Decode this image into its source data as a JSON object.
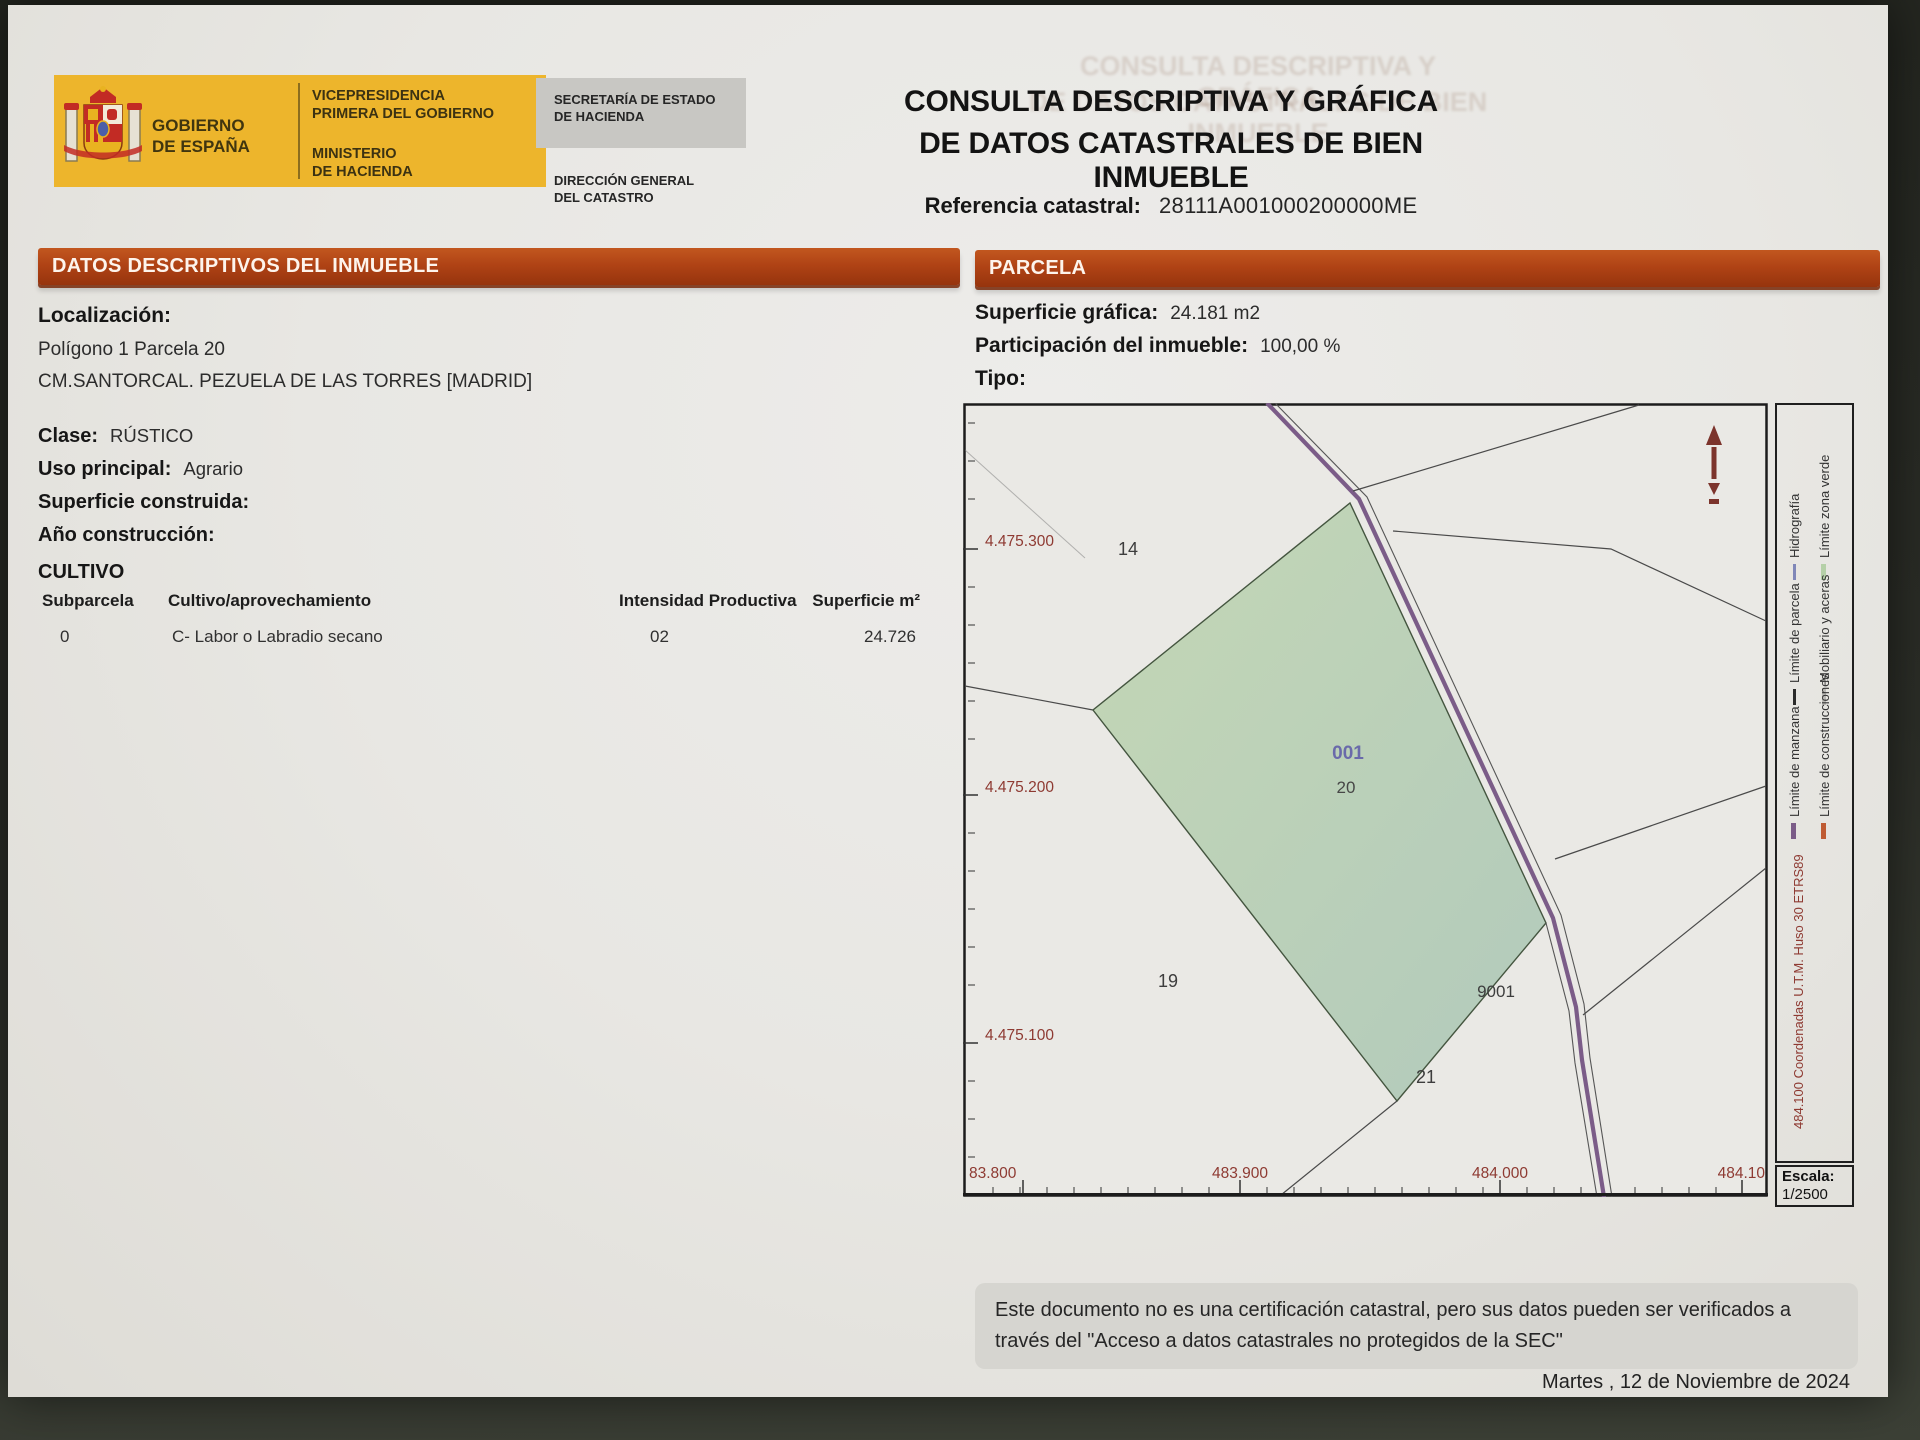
{
  "header": {
    "gobierno": "GOBIERNO\nDE ESPAÑA",
    "vicepresidencia": "VICEPRESIDENCIA\nPRIMERA DEL GOBIERNO",
    "ministerio": "MINISTERIO\nDE HACIENDA",
    "secretaria": "SECRETARÍA DE ESTADO\nDE HACIENDA",
    "direccion": "DIRECCIÓN GENERAL\nDEL CATASTRO",
    "title_line1": "CONSULTA DESCRIPTIVA Y GRÁFICA",
    "title_line2": "DE DATOS CATASTRALES DE BIEN INMUEBLE",
    "referencia_label": "Referencia catastral:",
    "referencia_value": "28111A001000200000ME"
  },
  "datos": {
    "section_title": "DATOS DESCRIPTIVOS DEL INMUEBLE",
    "localizacion_label": "Localización:",
    "localizacion_line1": "Polígono 1 Parcela 20",
    "localizacion_line2": "CM.SANTORCAL. PEZUELA DE LAS TORRES [MADRID]",
    "clase_label": "Clase:",
    "clase_value": "RÚSTICO",
    "uso_label": "Uso principal:",
    "uso_value": "Agrario",
    "superficie_label": "Superficie construida:",
    "anio_label": "Año construcción:",
    "cultivo_title": "CULTIVO",
    "cultivo_table": {
      "headers": [
        "Subparcela",
        "Cultivo/aprovechamiento",
        "Intensidad Productiva",
        "Superficie m²"
      ],
      "rows": [
        [
          "0",
          "C- Labor o Labradio secano",
          "02",
          "24.726"
        ]
      ]
    }
  },
  "parcela": {
    "section_title": "PARCELA",
    "superficie_grafica_label": "Superficie gráfica:",
    "superficie_grafica_value": "24.181 m2",
    "participacion_label": "Participación del inmueble:",
    "participacion_value": "100,00 %",
    "tipo_label": "Tipo:"
  },
  "map": {
    "y_axis_labels": [
      "4.475.300",
      "4.475.200",
      "4.475.100"
    ],
    "x_axis_labels": [
      "83.800",
      "483.900",
      "484.000",
      "484.10"
    ],
    "parcel_14": "14",
    "parcel_19": "19",
    "parcel_20": "20",
    "parcel_21": "21",
    "parcel_9001": "9001",
    "subparcela": "001",
    "escala_label": "Escala:",
    "escala_value": "1/2500",
    "north_arrow_icon": "north-arrow",
    "legend": {
      "hidrografia": "Hidrografía",
      "zona_verde": "Límite zona verde",
      "parcela": "Límite de parcela",
      "mobiliario": "Mobiliario y aceras",
      "manzana": "Límite de manzana",
      "construcciones": "Límite de construcciones",
      "coord_note": "484.100 Coordenadas U.T.M. Huso 30 ETRS89"
    }
  },
  "footer": {
    "disclaimer": "Este documento no es una certificación catastral, pero sus datos pueden ser verificados a\ntravés del \"Acceso a datos catastrales no protegidos de la SEC\"",
    "date": "Martes , 12 de Noviembre de 2024"
  },
  "colors": {
    "accent_orange": "#b04315",
    "logo_yellow": "#edb52c",
    "parcel_green": "#bdd3b4",
    "road_purple": "#7b5c88",
    "coord_maroon": "#8e3a32"
  }
}
